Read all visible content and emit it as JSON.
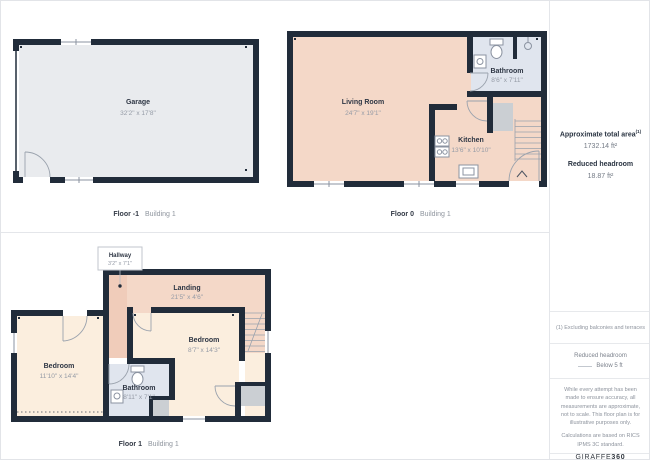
{
  "colors": {
    "wall": "#212c3a",
    "room_warm_pink": "#f4d8c8",
    "room_hallway_pink": "#f0ccba",
    "room_cream": "#fbeede",
    "room_bathroom_blue": "#e0e5ee",
    "room_garage_gray": "#e9ebee",
    "reduced_headroom_gray": "#cbcfd3",
    "divider": "#e4e6ea",
    "text_dark": "#2e3644",
    "text_muted": "#959ba6"
  },
  "sidebar": {
    "total_area_label": "Approximate total area",
    "total_area_sup": "(1)",
    "total_area_value": "1732.14 ft²",
    "reduced_headroom_label": "Reduced headroom",
    "reduced_headroom_value": "18.87 ft²",
    "footnote": "(1) Excluding balconies and terraces",
    "legend": {
      "title": "Reduced headroom",
      "item": "Below 5 ft"
    },
    "disclaimer_line1": "While every attempt has been made to ensure accuracy, all measurements are approximate, not to scale. This floor plan is for illustrative purposes only.",
    "disclaimer_line2": "Calculations are based on RICS IPMS 3C standard.",
    "logo": {
      "prefix": "GIRAFFE",
      "suffix": "360"
    }
  },
  "floors": {
    "minus1": {
      "caption_floor": "Floor -1",
      "caption_building": "Building 1",
      "rooms": {
        "garage": {
          "name": "Garage",
          "dims": "32'2\" x 17'8\""
        }
      }
    },
    "floor0": {
      "caption_floor": "Floor 0",
      "caption_building": "Building 1",
      "rooms": {
        "living": {
          "name": "Living Room",
          "dims": "24'7\" x 19'1\""
        },
        "kitchen": {
          "name": "Kitchen",
          "dims": "13'6\" x 10'10\""
        },
        "bathroom": {
          "name": "Bathroom",
          "dims": "8'6\" x 7'11\""
        }
      }
    },
    "floor1": {
      "caption_floor": "Floor 1",
      "caption_building": "Building 1",
      "rooms": {
        "hallway": {
          "name": "Hallway",
          "dims": "3'2\" x 7'1\""
        },
        "landing": {
          "name": "Landing",
          "dims": "21'5\" x 4'6\""
        },
        "bedroom_right": {
          "name": "Bedroom",
          "dims": "8'7\" x 14'3\""
        },
        "bedroom_left": {
          "name": "Bedroom",
          "dims": "11'10\" x 14'4\""
        },
        "bathroom": {
          "name": "Bathroom",
          "dims": "8'11\" x 7'1\""
        }
      }
    }
  }
}
